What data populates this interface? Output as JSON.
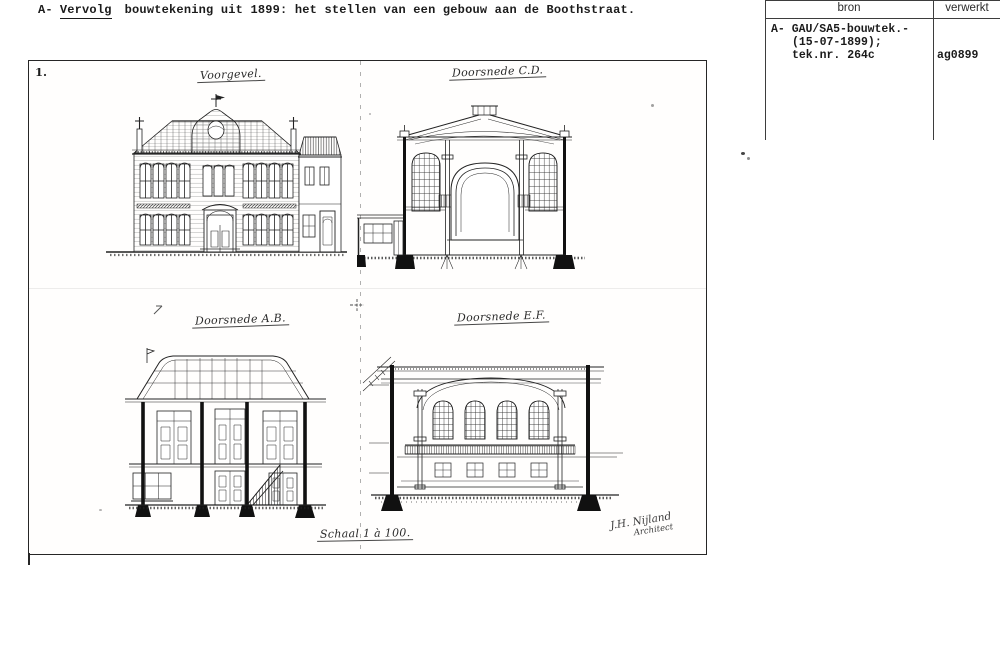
{
  "document": {
    "header": {
      "prefix": "A-",
      "emphasis": "Vervolg",
      "text": "bouwtekening uit 1899: het stellen van een gebouw aan de Boothstraat."
    },
    "register_table": {
      "columns": {
        "bron": "bron",
        "verwerkt": "verwerkt"
      },
      "entry": {
        "bron_line1": "A- GAU/SA5-bouwtek.-",
        "bron_line2": "(15-07-1899);",
        "bron_line3": "tek.nr. 264c",
        "verwerkt": "ag0899"
      }
    },
    "sheet": {
      "sheet_number": "1.",
      "titles": {
        "voorgevel": "Voorgevel.",
        "doorsnede_cd": "Doorsnede C.D.",
        "doorsnede_ab": "Doorsnede A.B.",
        "doorsnede_ef": "Doorsnede E.F."
      },
      "scale_note": "Schaal 1 à 100.",
      "signature": {
        "line1": "J.H. Nijland",
        "line2": "Architect"
      }
    },
    "colors": {
      "ink": "#1c1c1c",
      "paper": "#ffffff"
    }
  }
}
